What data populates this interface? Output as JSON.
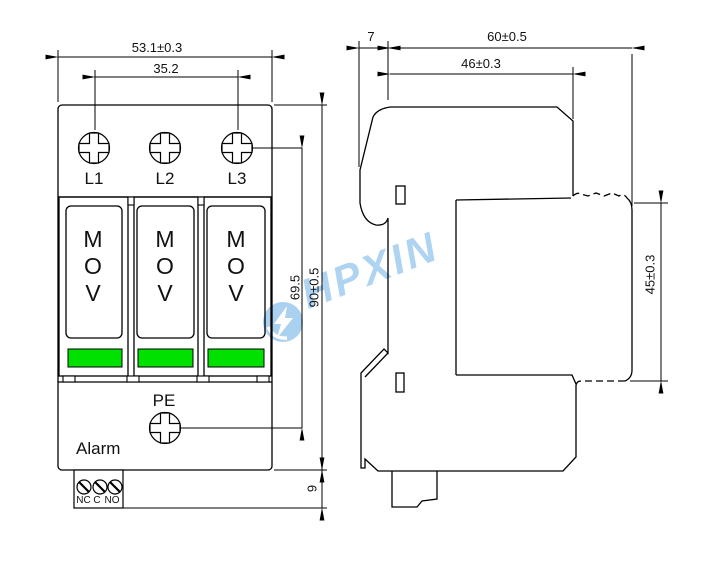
{
  "watermark": {
    "text": "HPXIN"
  },
  "front_view": {
    "dim_width_total": "53.1±0.3",
    "dim_width_terminals": "35.2",
    "dim_height_total": "90±0.5",
    "dim_height_to_pe": "69.5",
    "dim_terminal_block_height": "9",
    "terminal_labels": [
      "L1",
      "L2",
      "L3"
    ],
    "modules": [
      {
        "label": "MOV"
      },
      {
        "label": "MOV"
      },
      {
        "label": "MOV"
      }
    ],
    "pe_label": "PE",
    "alarm_label": "Alarm",
    "relay_terminal_labels": [
      "NC",
      "C",
      "NO"
    ]
  },
  "side_view": {
    "dim_clip_depth": "7",
    "dim_depth_total": "60±0.5",
    "dim_body_depth": "46±0.3",
    "dim_module_height": "45±0.3"
  },
  "colors": {
    "indicator": "#00e100",
    "watermark": "#9ccaee",
    "line": "#000000"
  }
}
